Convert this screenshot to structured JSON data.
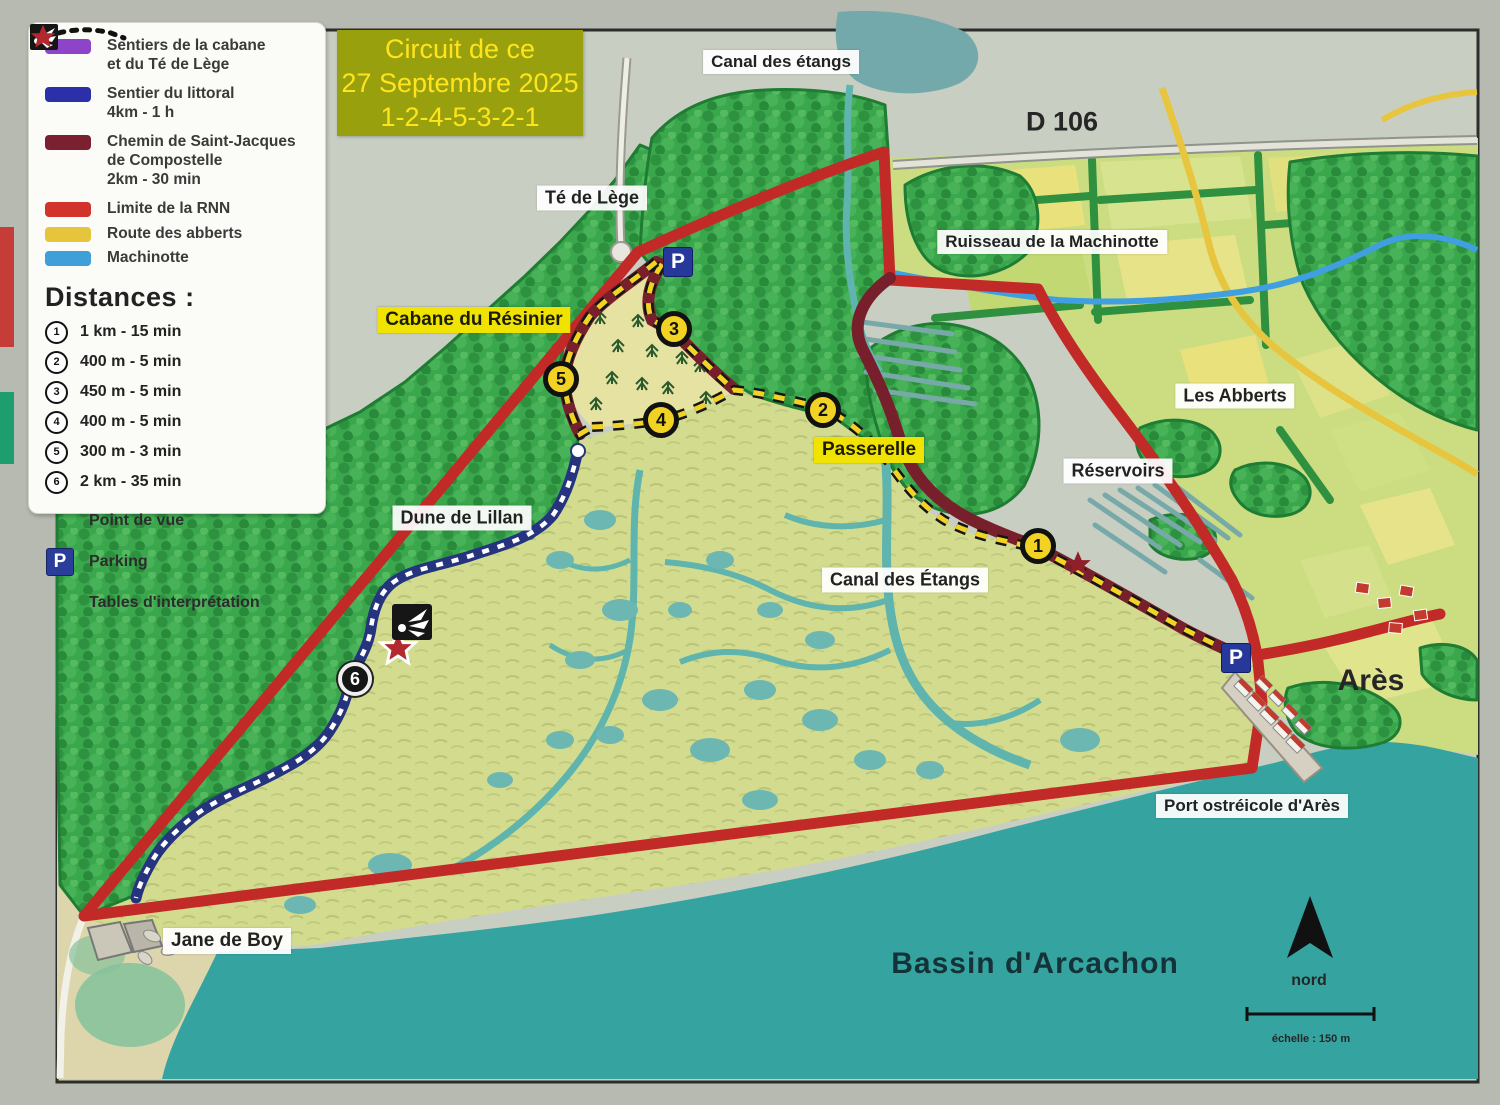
{
  "legend": {
    "trails": [
      {
        "name": "sentiers-cabane-te-de-lege",
        "color": "#8e44c8",
        "label": "Sentiers de la cabane\net du Té de Lège"
      },
      {
        "name": "sentier-du-littoral",
        "color": "#2b2fa8",
        "label": "Sentier du littoral\n4km - 1 h"
      },
      {
        "name": "chemin-de-saint-jacques",
        "color": "#7a2030",
        "label": "Chemin de Saint-Jacques\nde Compostelle\n2km - 30 min"
      },
      {
        "name": "limite-de-la-rnn",
        "color": "#d2342c",
        "label": "Limite de la RNN"
      },
      {
        "name": "route-des-abberts",
        "color": "#e6c53c",
        "label": "Route des abberts"
      },
      {
        "name": "machinotte",
        "color": "#3f9fd8",
        "label": "Machinotte"
      }
    ],
    "distances_title": "Distances :",
    "distances": [
      {
        "num": "1",
        "label": "1 km - 15 min"
      },
      {
        "num": "2",
        "label": "400 m - 5 min"
      },
      {
        "num": "3",
        "label": "450 m - 5 min"
      },
      {
        "num": "4",
        "label": "400 m - 5 min"
      },
      {
        "num": "5",
        "label": "300 m - 3 min"
      },
      {
        "num": "6",
        "label": "2 km - 35 min"
      }
    ],
    "symbols": [
      {
        "name": "point-de-vue",
        "label": "Point de vue"
      },
      {
        "name": "parking",
        "label": "Parking"
      },
      {
        "name": "tables-interpretation",
        "label": "Tables d'interprétation"
      }
    ]
  },
  "title_box": {
    "lines": [
      "Circuit de ce",
      "27 Septembre 2025",
      "1-2-4-5-3-2-1"
    ],
    "bg_color": "#99a00d",
    "text_color": "#ffe41c"
  },
  "map_labels": {
    "canal_des_etangs_nord": "Canal des étangs",
    "d106": "D 106",
    "te_de_lege": "Té de Lège",
    "ruisseau_machinotte": "Ruisseau de la Machinotte",
    "cabane_du_resinier": "Cabane du Résinier",
    "les_abberts": "Les Abberts",
    "passerelle": "Passerelle",
    "reservoirs": "Réservoirs",
    "dune_de_lillan": "Dune de Lillan",
    "canal_des_etangs": "Canal des Étangs",
    "ares": "Arès",
    "port_ostreicole": "Port ostréicole d'Arès",
    "jane_de_boy": "Jane de Boy",
    "bassin_arcachon": "Bassin d'Arcachon"
  },
  "markers": {
    "stops": [
      "1",
      "2",
      "3",
      "4",
      "5",
      "6"
    ],
    "parking_label": "P"
  },
  "compass_label": "nord",
  "scale_label": "échelle : 150 m",
  "colors": {
    "rnn_boundary": "#c22a28",
    "compostelle": "#77202c",
    "littoral": "#26337f",
    "circuit_dash": "#f2d324",
    "machinotte": "#3f9fe0",
    "route_abberts": "#e8c53f",
    "water": "#35a4a0",
    "forest": "#3aa74d",
    "marsh": "#d2db8c",
    "title_bg": "#99a00d"
  }
}
